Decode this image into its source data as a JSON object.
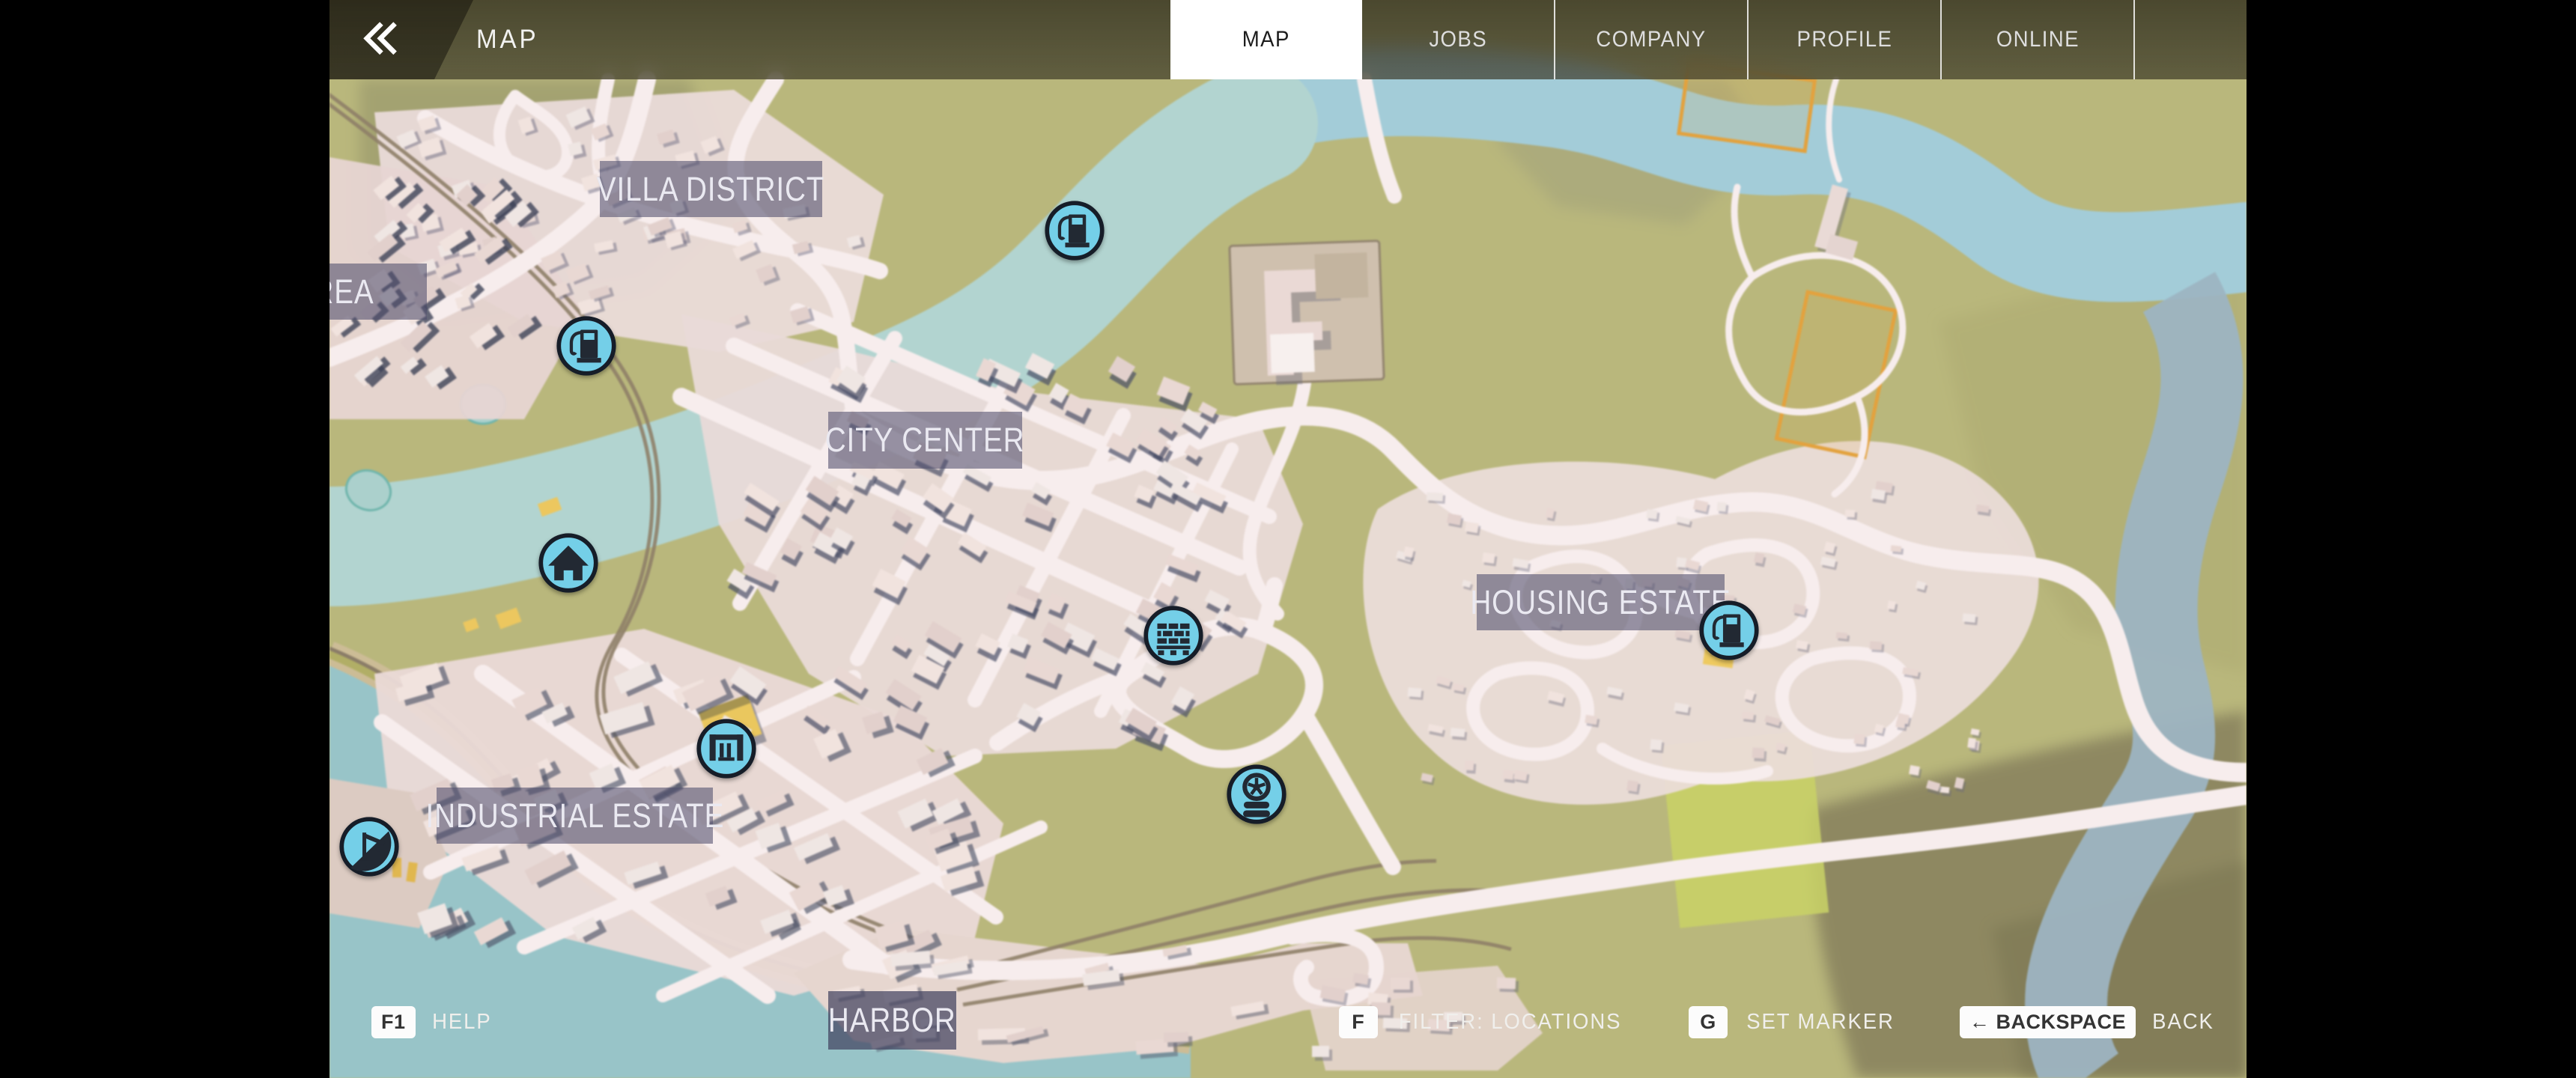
{
  "header": {
    "back_label": "«",
    "title": "MAP",
    "tabs": [
      {
        "label": "MAP",
        "active": true
      },
      {
        "label": "JOBS",
        "active": false
      },
      {
        "label": "COMPANY",
        "active": false
      },
      {
        "label": "PROFILE",
        "active": false
      },
      {
        "label": "ONLINE",
        "active": false
      }
    ]
  },
  "map": {
    "region_labels": [
      {
        "id": "villa-district",
        "text": "VILLA DISTRICT"
      },
      {
        "id": "area",
        "text": "L AREA"
      },
      {
        "id": "city-center",
        "text": "CITY CENTER"
      },
      {
        "id": "housing-estate",
        "text": "HOUSING ESTATE"
      },
      {
        "id": "industrial-estate",
        "text": "INDUSTRIAL ESTATE"
      },
      {
        "id": "harbor",
        "text": "HARBOR"
      }
    ],
    "markers": [
      {
        "icon": "fuel-pump-icon"
      },
      {
        "icon": "fuel-pump-icon"
      },
      {
        "icon": "home-icon"
      },
      {
        "icon": "fuel-pump-icon"
      },
      {
        "icon": "building-materials-icon"
      },
      {
        "icon": "garage-icon"
      },
      {
        "icon": "tire-shop-icon"
      },
      {
        "icon": "harbor-crane-icon"
      }
    ]
  },
  "hints": {
    "left": [
      {
        "key": "F1",
        "label": "HELP"
      }
    ],
    "right": [
      {
        "key": "F",
        "label": "FILTER: LOCATIONS"
      },
      {
        "key": "G",
        "label": "SET MARKER"
      },
      {
        "key": "← BACKSPACE",
        "label": "BACK"
      }
    ]
  },
  "colors": {
    "marker-blue": "#74cfe8",
    "label-bg": "rgba(80,78,108,0.58)",
    "tab-active-bg": "#ffffff"
  }
}
